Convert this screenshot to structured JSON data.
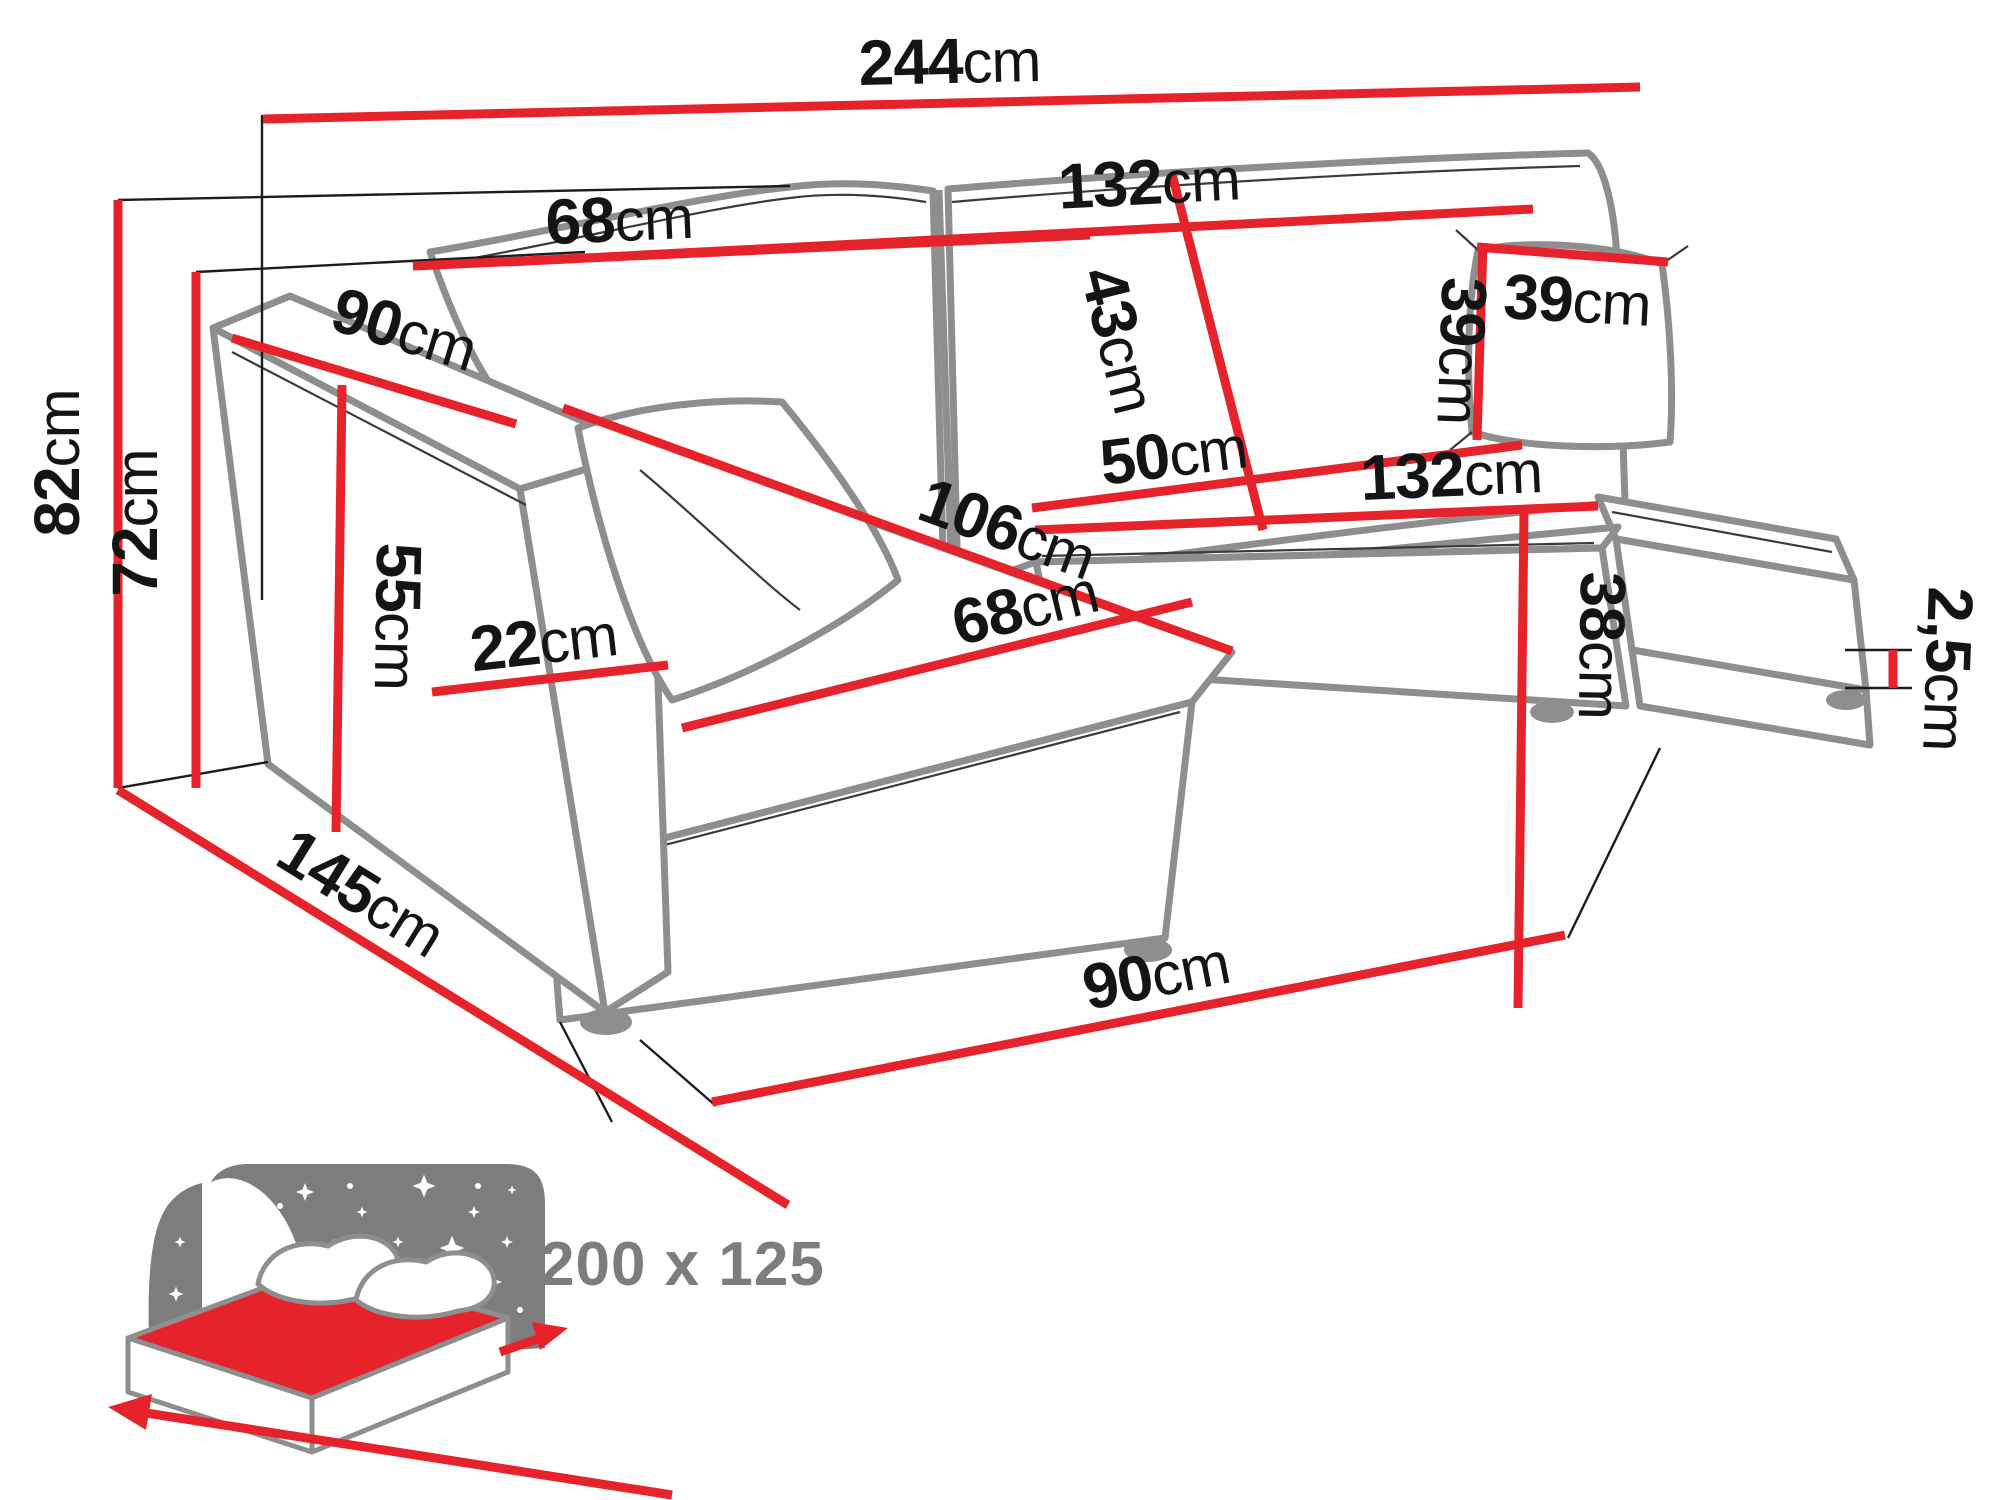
{
  "diagram": {
    "type": "corner-sofa-dimension-drawing",
    "unit": "cm",
    "dimensions": [
      {
        "name": "total-width",
        "num": "244",
        "unit": "cm"
      },
      {
        "name": "backrest-right-width",
        "num": "132",
        "unit": "cm"
      },
      {
        "name": "backrest-left-cushion-width",
        "num": "68",
        "unit": "cm"
      },
      {
        "name": "backrest-height",
        "num": "43",
        "unit": "cm"
      },
      {
        "name": "pillow-width",
        "num": "39",
        "unit": "cm"
      },
      {
        "name": "pillow-height",
        "num": "39",
        "unit": "cm"
      },
      {
        "name": "seat-depth",
        "num": "50",
        "unit": "cm"
      },
      {
        "name": "seat-width",
        "num": "132",
        "unit": "cm"
      },
      {
        "name": "chaise-length",
        "num": "106",
        "unit": "cm"
      },
      {
        "name": "chaise-cushion-width",
        "num": "68",
        "unit": "cm"
      },
      {
        "name": "seat-height",
        "num": "38",
        "unit": "cm"
      },
      {
        "name": "leg-height",
        "num": "2,5",
        "unit": "cm"
      },
      {
        "name": "armrest-depth",
        "num": "90",
        "unit": "cm"
      },
      {
        "name": "total-height",
        "num": "82",
        "unit": "cm"
      },
      {
        "name": "backrest-top-height",
        "num": "72",
        "unit": "cm"
      },
      {
        "name": "armrest-height",
        "num": "55",
        "unit": "cm"
      },
      {
        "name": "armrest-width",
        "num": "22",
        "unit": "cm"
      },
      {
        "name": "total-depth",
        "num": "145",
        "unit": "cm"
      },
      {
        "name": "floor-front-width",
        "num": "90",
        "unit": "cm"
      }
    ],
    "sleeping_area": {
      "label": "200 x 125"
    },
    "colors": {
      "dimension_red": "#e6232a",
      "outline_gray": "#8e8e8e",
      "label_black": "#141414",
      "icon_gray": "#7d7d7d"
    }
  }
}
